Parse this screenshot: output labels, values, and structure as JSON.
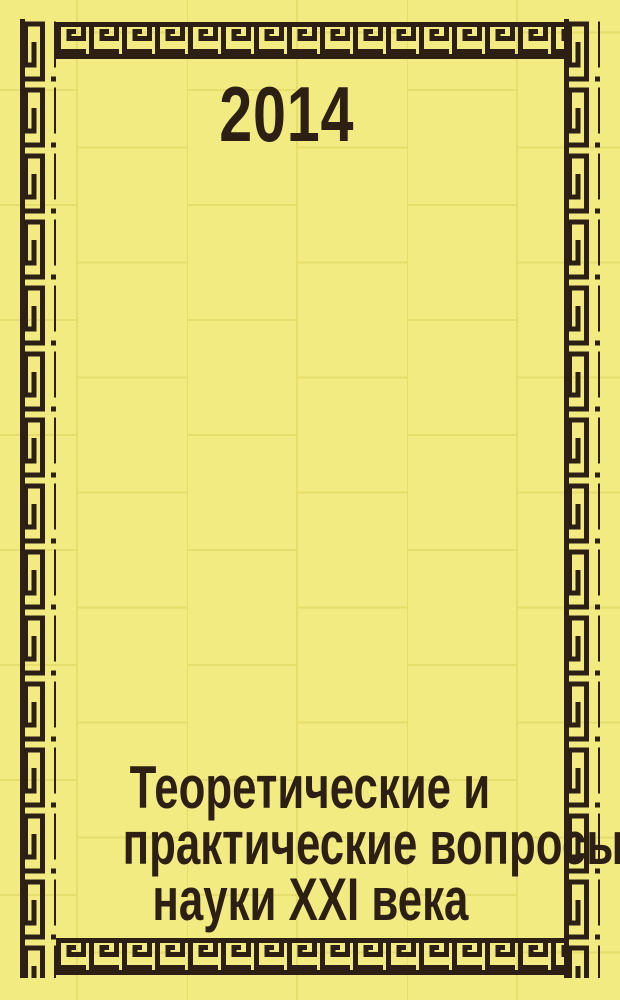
{
  "cover": {
    "year": "2014",
    "title_lines": [
      "Теоретические и",
      "практические вопросы",
      "науки XXI века"
    ],
    "decor": {
      "border_style": "greek-key-meander",
      "background_style": "brick-tile-wall"
    },
    "colors": {
      "ink": "#2e1f15",
      "background": "#f2eb81",
      "tile_line": "#e5de6d"
    }
  }
}
